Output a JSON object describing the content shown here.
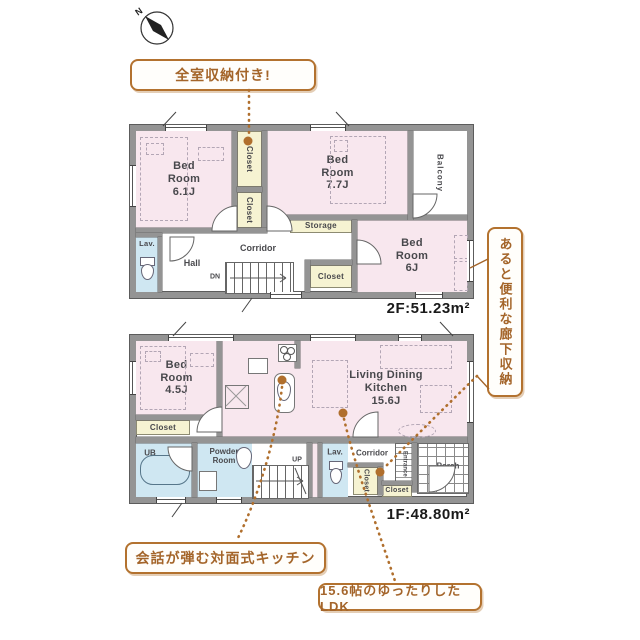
{
  "compass": {
    "north_label": "N"
  },
  "callouts": {
    "all_rooms_storage": "全室収納付き!",
    "hallway_storage": "あると便利な廊下収納",
    "kitchen": "会話が弾む対面式キッチン",
    "ldk": "15.6帖のゆったりしたLDK"
  },
  "floor2": {
    "area_label": "2F:51.23m²",
    "rooms": {
      "bedroom_61": "Bed\nRoom\n6.1J",
      "closet_top": "Closet",
      "closet_mid": "Closet",
      "bedroom_77": "Bed\nRoom\n7.7J",
      "balcony": "Balcony",
      "storage": "Storage",
      "bedroom_6": "Bed\nRoom\n6J",
      "closet_bottom": "Closet",
      "lavatory": "Lav.",
      "hall": "Hall",
      "corridor": "Corridor",
      "stairs_down": "DN"
    }
  },
  "floor1": {
    "area_label": "1F:48.80m²",
    "rooms": {
      "bedroom_45": "Bed\nRoom\n4.5J",
      "closet_bedroom": "Closet",
      "unit_bath": "UB",
      "powder_room": "Powder\nRoom",
      "washer": "W",
      "stairs_up": "UP",
      "lavatory": "Lav.",
      "corridor": "Corridor",
      "closet_corridor": "Closet",
      "entrance": "Entrance",
      "closet_entrance": "Closet",
      "porch": "Porch",
      "ldk": "Living Dining\nKitchen\n15.6J"
    }
  },
  "colors": {
    "room_pink": "#f8e7ee",
    "closet_yellow": "#f6f3d2",
    "wet_area_blue": "#cfe7f2",
    "wall_gray": "#949494",
    "accent_brown": "#a4652a",
    "marker_brown": "#b06f2d"
  }
}
